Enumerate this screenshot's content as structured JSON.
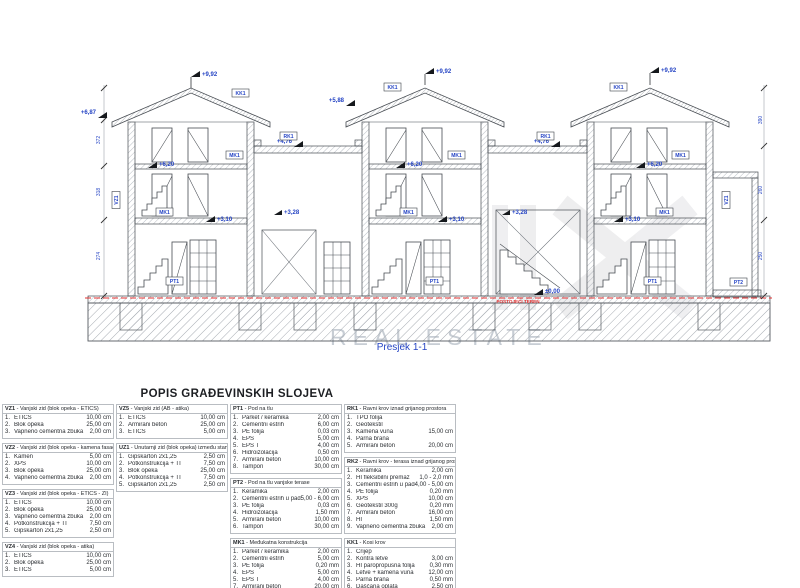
{
  "drawing": {
    "caption": "Presjek 1-1",
    "terrain_note": "POSTOJEĆI TEREN",
    "watermark": "REAL ESTATE",
    "labels": {
      "ridge": "+9,92",
      "eave_left": "+6,87",
      "eave_mid": "+5,88",
      "flat": "+4,76",
      "attic": "+6,20",
      "floor": "+3,10",
      "landing": "+3,28",
      "zero": "±0,00"
    },
    "tags": {
      "kk1": "KK1",
      "mk1": "MK1",
      "rk1": "RK1",
      "pt1": "PT1",
      "pt2": "PT2",
      "vz1": "VZ1"
    },
    "dims": [
      "372",
      "390",
      "318",
      "274",
      "260",
      "250"
    ]
  },
  "legend": {
    "title": "POPIS GRAĐEVINSKIH SLOJEVA",
    "columns": [
      [
        {
          "code": "VZ1",
          "name": "Vanjski zid (blok opeka - ETICS)",
          "rows": [
            {
              "n": "1.",
              "label": "ETICS",
              "value": "10,00 cm"
            },
            {
              "n": "2.",
              "label": "Blok opeka",
              "value": "25,00 cm"
            },
            {
              "n": "3.",
              "label": "Vapneno cementna žbuka",
              "value": "2,00 cm"
            }
          ]
        },
        {
          "code": "VZ2",
          "name": "Vanjski zid (blok opeka - kamena fasada)",
          "rows": [
            {
              "n": "1.",
              "label": "Kamen",
              "value": "5,00 cm"
            },
            {
              "n": "2.",
              "label": "XPS",
              "value": "10,00 cm"
            },
            {
              "n": "3.",
              "label": "Blok opeka",
              "value": "25,00 cm"
            },
            {
              "n": "4.",
              "label": "Vapneno cementna žbuka",
              "value": "2,00 cm"
            }
          ]
        },
        {
          "code": "VZ3",
          "name": "Vanjski zid (blok opeka - ETICS - ZI)",
          "rows": [
            {
              "n": "1.",
              "label": "ETICS",
              "value": "10,00 cm"
            },
            {
              "n": "2.",
              "label": "Blok opeka",
              "value": "25,00 cm"
            },
            {
              "n": "3.",
              "label": "Vapneno cementna žbuka",
              "value": "2,00 cm"
            },
            {
              "n": "4.",
              "label": "Potkonstrukcija + TI",
              "value": "7,50 cm"
            },
            {
              "n": "5.",
              "label": "Gipskarton 2x1,25",
              "value": "2,50 cm"
            }
          ]
        },
        {
          "code": "VZ4",
          "name": "Vanjski zid (blok opeka - atika)",
          "rows": [
            {
              "n": "1.",
              "label": "ETICS",
              "value": "10,00 cm"
            },
            {
              "n": "2.",
              "label": "Blok opeka",
              "value": "25,00 cm"
            },
            {
              "n": "3.",
              "label": "ETICS",
              "value": "5,00 cm"
            }
          ]
        }
      ],
      [
        {
          "code": "VZ5",
          "name": "Vanjski zid (AB - atika)",
          "rows": [
            {
              "n": "1.",
              "label": "ETICS",
              "value": "10,00 cm"
            },
            {
              "n": "2.",
              "label": "Armirani beton",
              "value": "25,00 cm"
            },
            {
              "n": "3.",
              "label": "ETICS",
              "value": "5,00 cm"
            }
          ]
        },
        {
          "code": "UZ1",
          "name": "Unutarnji zid (blok opeka) između stanova",
          "rows": [
            {
              "n": "1.",
              "label": "Gipskarton 2x1,25",
              "value": "2,50 cm"
            },
            {
              "n": "2.",
              "label": "Potkonstrukcija + TI",
              "value": "7,50 cm"
            },
            {
              "n": "3.",
              "label": "Blok opeka",
              "value": "25,00 cm"
            },
            {
              "n": "4.",
              "label": "Potkonstrukcija + TI",
              "value": "7,50 cm"
            },
            {
              "n": "5.",
              "label": "Gipskarton 2x1,25",
              "value": "2,50 cm"
            }
          ]
        }
      ],
      [
        {
          "code": "PT1",
          "name": "Pod na tlu",
          "rows": [
            {
              "n": "1.",
              "label": "Parket / keramika",
              "value": "2,00 cm"
            },
            {
              "n": "2.",
              "label": "Cementni estrih",
              "value": "6,00 cm"
            },
            {
              "n": "3.",
              "label": "PE folija",
              "value": "0,03 cm"
            },
            {
              "n": "4.",
              "label": "EPS",
              "value": "5,00 cm"
            },
            {
              "n": "5.",
              "label": "EPS T",
              "value": "4,00 cm"
            },
            {
              "n": "6.",
              "label": "Hidroizolacija",
              "value": "0,50 cm"
            },
            {
              "n": "7.",
              "label": "Armirani beton",
              "value": "10,00 cm"
            },
            {
              "n": "8.",
              "label": "Tampon",
              "value": "30,00 cm"
            }
          ]
        },
        {
          "code": "PT2",
          "name": "Pod na tlu vanjske terase",
          "rows": [
            {
              "n": "1.",
              "label": "Keramika",
              "value": "2,00 cm"
            },
            {
              "n": "2.",
              "label": "Cementni estrih u padu",
              "value": "5,00 - 6,00 cm"
            },
            {
              "n": "3.",
              "label": "PE folija",
              "value": "0,03 cm"
            },
            {
              "n": "4.",
              "label": "Hidroizolacija",
              "value": "1,50 mm"
            },
            {
              "n": "5.",
              "label": "Armirani beton",
              "value": "10,00 cm"
            },
            {
              "n": "6.",
              "label": "Tampon",
              "value": "30,00 cm"
            }
          ]
        },
        {
          "code": "MK1",
          "name": "Međukatna konstrukcija",
          "rows": [
            {
              "n": "1.",
              "label": "Parket / keramika",
              "value": "2,00 cm"
            },
            {
              "n": "2.",
              "label": "Cementni estrih",
              "value": "5,00 cm"
            },
            {
              "n": "3.",
              "label": "PE folija",
              "value": "0,20 mm"
            },
            {
              "n": "4.",
              "label": "EPS",
              "value": "5,00 cm"
            },
            {
              "n": "5.",
              "label": "EPS T",
              "value": "4,00 cm"
            },
            {
              "n": "7.",
              "label": "Armirani beton",
              "value": "20,00 cm"
            },
            {
              "n": "8.",
              "label": "Vapneno cementna žbuka",
              "value": "2,00 cm"
            }
          ]
        }
      ],
      [
        {
          "code": "RK1",
          "name": "Ravni krov iznad grijanog prostora",
          "rows": [
            {
              "n": "1.",
              "label": "TPO folija",
              "value": ""
            },
            {
              "n": "2.",
              "label": "Geotekstil",
              "value": ""
            },
            {
              "n": "3.",
              "label": "Kamena vuna",
              "value": "15,00 cm"
            },
            {
              "n": "4.",
              "label": "Parna brana",
              "value": ""
            },
            {
              "n": "5.",
              "label": "Armirani beton",
              "value": "20,00 cm"
            }
          ]
        },
        {
          "code": "RK2",
          "name": "Ravni krov - terasa iznad grijanog prostora",
          "rows": [
            {
              "n": "1.",
              "label": "Keramika",
              "value": "2,00 cm"
            },
            {
              "n": "2.",
              "label": "HI fleksibilni premaz",
              "value": "1,0 - 2,0 mm"
            },
            {
              "n": "3.",
              "label": "Cementni estrih u padu",
              "value": "4,00 - 5,00 cm"
            },
            {
              "n": "4.",
              "label": "PE folija",
              "value": "0,20 mm"
            },
            {
              "n": "5.",
              "label": "XPS",
              "value": "10,00 cm"
            },
            {
              "n": "6.",
              "label": "Geotekstil 300g",
              "value": "0,20 mm"
            },
            {
              "n": "7.",
              "label": "Armirani beton",
              "value": "16,00 cm"
            },
            {
              "n": "8.",
              "label": "HI",
              "value": "1,50 mm"
            },
            {
              "n": "9.",
              "label": "Vapneno cementna žbuka",
              "value": "2,00 cm"
            }
          ]
        },
        {
          "code": "KK1",
          "name": "Kosi krov",
          "rows": [
            {
              "n": "1.",
              "label": "Crijep",
              "value": ""
            },
            {
              "n": "2.",
              "label": "Kontra letve",
              "value": "3,00 cm"
            },
            {
              "n": "3.",
              "label": "HI paropropusna folija",
              "value": "0,30 mm"
            },
            {
              "n": "4.",
              "label": "Letve + kamena vuna",
              "value": "12,00 cm"
            },
            {
              "n": "5.",
              "label": "Parna brana",
              "value": "0,50 mm"
            },
            {
              "n": "6.",
              "label": "Daščana oplata",
              "value": "2,50 cm"
            },
            {
              "n": "7.",
              "label": "Nosiva drvena konstrukcija",
              "value": ""
            }
          ]
        }
      ]
    ]
  }
}
